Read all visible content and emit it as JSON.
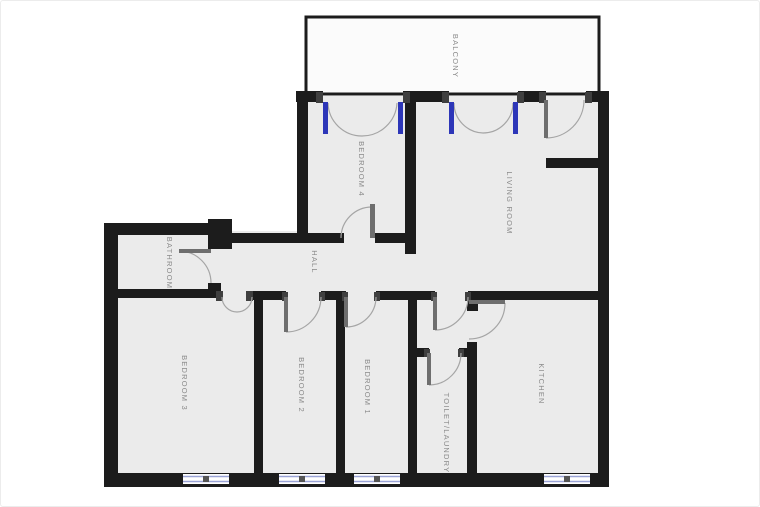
{
  "plan": {
    "rooms": [
      {
        "id": "balcony",
        "label": "BALCONY"
      },
      {
        "id": "bedroom-4",
        "label": "BEDROOM 4"
      },
      {
        "id": "living-room",
        "label": "LIVING ROOM"
      },
      {
        "id": "bathroom",
        "label": "BATHROOM"
      },
      {
        "id": "hall",
        "label": "HALL"
      },
      {
        "id": "bedroom-3",
        "label": "BEDROOM 3"
      },
      {
        "id": "bedroom-2",
        "label": "BEDROOM 2"
      },
      {
        "id": "bedroom-1",
        "label": "BEDROOM 1"
      },
      {
        "id": "toilet-laundry",
        "label": "TOILET/LAUNDRY"
      },
      {
        "id": "kitchen",
        "label": "KITCHEN"
      }
    ],
    "colors": {
      "background": "#ffffff",
      "room_fill": "#ebebeb",
      "balcony_fill": "#fbfbfb",
      "wall": "#1c1c1c",
      "jamb": "#3f3f3f",
      "door_arc": "#a5a5a5",
      "door_leaf": "#6e6e6e",
      "glazed_door": "#2d36b8",
      "window": "#9aa3d6",
      "window_fill": "#ffffff",
      "window_dot": "#555555",
      "label": "#8a8a8a"
    }
  }
}
